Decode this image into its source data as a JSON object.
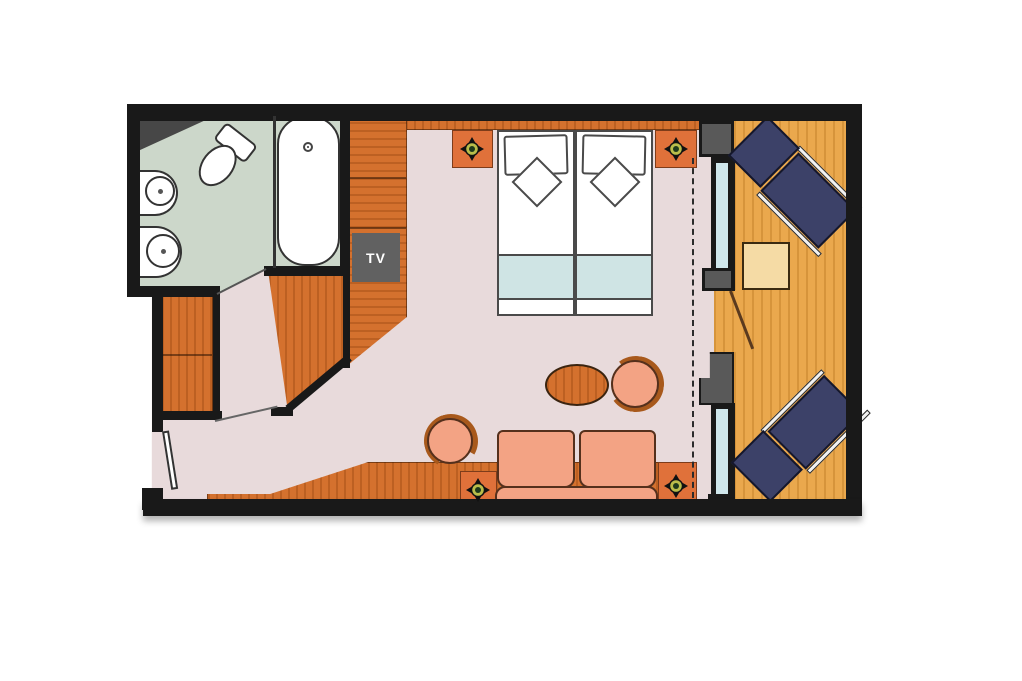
{
  "title": "Cabin with balcony floor plan",
  "labels": {
    "tv": "TV"
  },
  "colors": {
    "wall": "#191919",
    "carpet": "#e8dadb",
    "bath": "#ccd7ca",
    "wood": "#d4712e",
    "wood-dark": "#a8591c",
    "nightstand": "#e0713a",
    "balcony": "#eaa84d",
    "gray": "#595959",
    "tvgray": "#616161",
    "glass": "#cfe7ec",
    "navy": "#3c4168",
    "salmon": "#f3a384",
    "blanket": "#cfe4e4",
    "table-beige": "#f5dba5",
    "lamp-ring": "#b9bd4a",
    "lamp-center": "#1d3a1c"
  },
  "rooms": {
    "bathroom": {
      "name": "bathroom",
      "furniture": [
        "toilet",
        "washbasin",
        "washbasin",
        "bathtub"
      ]
    },
    "cabin": {
      "name": "cabin",
      "furniture": [
        "wardrobe-column",
        "tv-panel",
        "closet-cabinet",
        "entry-wardrobe",
        "twin-bed",
        "twin-bed",
        "nightstand",
        "nightstand",
        "reading-lamp",
        "reading-lamp",
        "reading-lamp",
        "reading-lamp",
        "oval-coffee-table",
        "round-chair",
        "round-chair",
        "sofa",
        "desk-counter",
        "entry-door"
      ]
    },
    "balcony": {
      "name": "balcony",
      "furniture": [
        "lounger",
        "lounger",
        "side-table",
        "balcony-door"
      ]
    }
  }
}
